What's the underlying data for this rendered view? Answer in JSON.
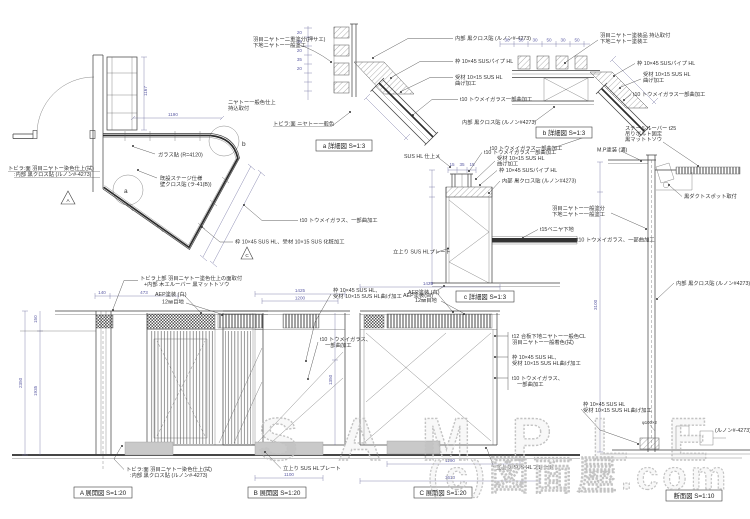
{
  "watermark": {
    "sample": "SAMPLE",
    "site": "(c)図面屋.com"
  },
  "colors": {
    "line": "#3d3d3d",
    "dim_text": "#5d5da5",
    "plinth": "#c9c9c9",
    "watermark": "#c3c3c3"
  },
  "titles": {
    "detail_a": "a 詳細図  S=1:3",
    "detail_b": "b 詳細図  S=1:3",
    "detail_c": "c 詳細図  S=1:3",
    "elev_a": "A 展開図  S=1:20",
    "elev_b": "B 展開図  S=1:20",
    "elev_c": "C 展開図  S=1:20",
    "section": "断面図  S=1:10"
  },
  "markers": {
    "a": "a",
    "b": "b",
    "c": "C",
    "a_view": "A"
  },
  "ann": {
    "plan_glass_r": "ガラス貼 (R=4120)",
    "plan_stage1": "既設ステージ仕様",
    "plan_stage2": "壁クロス貼 (ラ-41(B))",
    "plan_glass": "t10 トウメイガラス、一部曲加工",
    "plan_frame": "枠 10×45 SUS HL、受材 10×15 SUS 化粧加工",
    "plan_door1": "トビラ:面 羽目ニヤトー染色仕上(拭)",
    "plan_door2": ":内部 黒クロス貼 (ルノン#-4273)",
    "da_top1": "羽目ニヤトー二重塗分(押サエ)",
    "da_top2": "下地ニヤトー一般塗工",
    "da_left1": "ニヤトー一般色仕上",
    "da_left2": "持込取付",
    "da_door": "トビラ:面 ニヤトー一般色",
    "da_cloth": "内部 黒クロス貼 (ルノン#-4273)",
    "da_frame": "枠 10×45 SUSパイプ HL",
    "da_uke1": "受材 10×15 SUS HL",
    "da_uke2": "曲げ加工",
    "da_glass": "t10 トウメイガラス一部曲加工",
    "db_top1": "羽目ニヤトー塗装品 持込取付",
    "db_top2": "下地ニヤトー塗装工",
    "db_frame": "枠 10×45 SUSパイプ HL",
    "db_uke1": "受材 10×15 SUS HL",
    "db_uke2": "曲げ加工",
    "db_glass": "t10 トウメイガラス一部曲加工",
    "db_cloth": "内部 黒クロス貼 (ルノン#4273)",
    "db_louver1": "スチールルーバー t25",
    "db_louver2": "吊りボルト固定",
    "db_louver3": "黒マットトソウ",
    "db_glass2": "t10 トウメイガラス一部曲加工",
    "db_mp": "M.P塗装 (濃)",
    "dc_glass": "t10 トウメイガラス一部曲加工",
    "dc_uke1": "受材 10×15 SUS HL",
    "dc_uke2": "曲げ加工",
    "dc_frame": "枠 10×45 SUSパイプ HL",
    "dc_cloth": "内部 黒クロス貼 (ルノン#4273)",
    "dc_sus": "SUS HL 仕上メ",
    "dc_plate": "立上り SUS HLプレート",
    "dc_veneer": "t15ベニヤ下地",
    "dc_glass2": "t10 トウメイガラス、一部曲加工",
    "dc_aep": "AEP塗装(白)",
    "sec_nyatoh1": "羽目ニヤトー一般塗分",
    "sec_nyatoh2": "下地ニヤトー一般塗工",
    "sec_spot": "黒ダクトスポット取付",
    "sec_cloth": "内部 黒クロス貼 (ルノン#4273)",
    "sec_runon": "(ルノン#-4273)",
    "sec_phi": "φ100×2",
    "e1a": "トビラ上部 羽目ニヤトー塗色仕上の面取付",
    "e1b": "+内部 木エルーバー 黒マットトソウ",
    "e2": "AEP塗装 (白)",
    "e3": "12㎜目地",
    "e4a": "枠 10×45 SUS HL、",
    "e4b": "受材 10×15 SUS HL曲げ加工",
    "e5": "AEP塗装 (白)",
    "e6": "12㎜目地",
    "e7a": "t10 トウメイガラス、",
    "e7b": "一部曲加工",
    "e8a": "t12 合板下地ニヤトー一般色CL",
    "e8b": "羽目ニヤトー一般着色(拭)",
    "e9a": "枠 10×45 SUS HL、",
    "e9b": "受材 10×15 SUS HL曲げ加工",
    "e10a": "t10 トウメイガラス、",
    "e10b": "一部曲加工",
    "e11a": "枠 10×45 SUS HL",
    "e11b": "受材 10×15 SUS HL曲げ加工",
    "e12a": "トビラ:面 羽目ニヤトー染色仕上(拭)",
    "e12b": ":内部 黒クロス貼 (ルノン#-4273)",
    "e13": "立上り SUS HLプレート",
    "e14": "立上り SUS HLプレート"
  },
  "dims": {
    "d1167": "1167",
    "d1190": "1190",
    "d140": "140",
    "d473": "473",
    "d1425": "1425",
    "d1200": "1200",
    "d1100": "1100",
    "d1190b": "1190",
    "d1610": "1610",
    "d2350": "2350",
    "d150": "150",
    "d1935": "1935",
    "d1350": "1350",
    "d3100": "3100",
    "chain_a": [
      "20",
      "35",
      "20",
      "35",
      "20"
    ],
    "chain_b": [
      "30",
      "50",
      "30",
      "50",
      "30",
      "50"
    ],
    "chain_c": [
      "15",
      "35",
      "15"
    ]
  }
}
